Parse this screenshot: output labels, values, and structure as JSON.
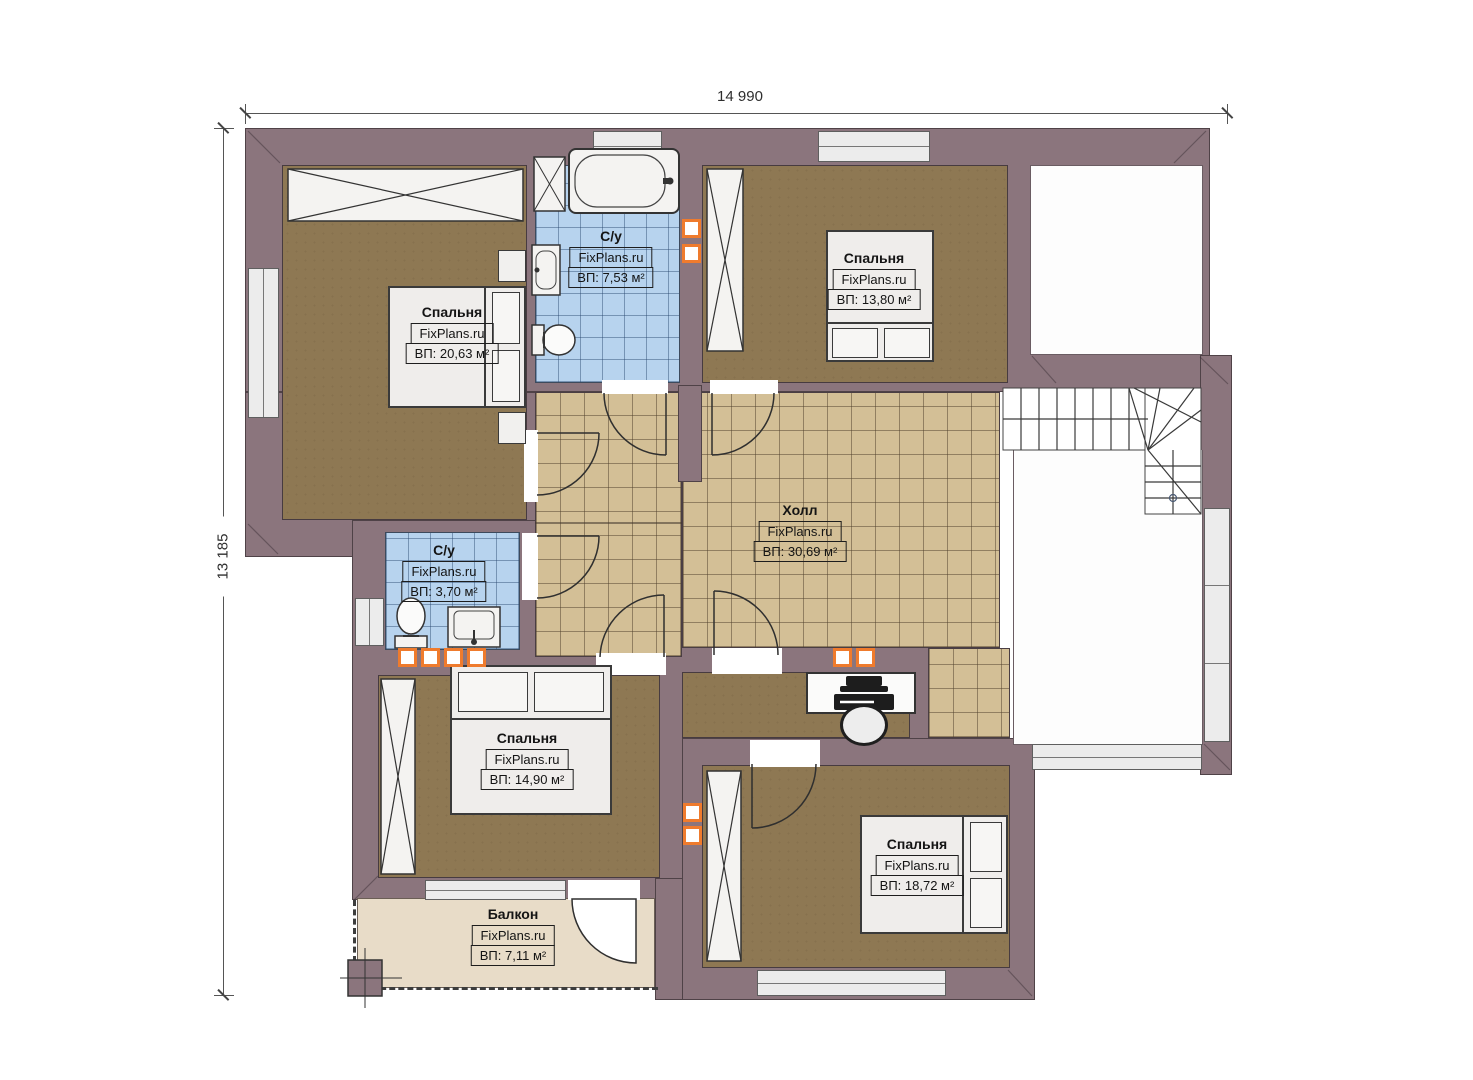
{
  "dimensions": {
    "width_label": "14 990",
    "height_label": "13 185"
  },
  "rooms": [
    {
      "id": "bedroom-top-left",
      "name": "Спальня",
      "site": "FixPlans.ru",
      "area": "ВП: 20,63 м²"
    },
    {
      "id": "bathroom-top",
      "name": "С/у",
      "site": "FixPlans.ru",
      "area": "ВП: 7,53 м²"
    },
    {
      "id": "bedroom-top-right",
      "name": "Спальня",
      "site": "FixPlans.ru",
      "area": "ВП: 13,80 м²"
    },
    {
      "id": "hall",
      "name": "Холл",
      "site": "FixPlans.ru",
      "area": "ВП: 30,69 м²"
    },
    {
      "id": "bathroom-small",
      "name": "С/у",
      "site": "FixPlans.ru",
      "area": "ВП: 3,70 м²"
    },
    {
      "id": "bedroom-bottom-left",
      "name": "Спальня",
      "site": "FixPlans.ru",
      "area": "ВП: 14,90 м²"
    },
    {
      "id": "bedroom-bottom-right",
      "name": "Спальня",
      "site": "FixPlans.ru",
      "area": "ВП: 18,72 м²"
    },
    {
      "id": "balcony",
      "name": "Балкон",
      "site": "FixPlans.ru",
      "area": "ВП: 7,11 м²"
    }
  ],
  "colors": {
    "wall": "#8b757d",
    "wood_floor": "#8e7853",
    "hall_tile": "#d3bf96",
    "bath_tile": "#b7d3ee",
    "balcony_floor": "#e8dcc8",
    "vent_accent": "#ef7b2d"
  }
}
